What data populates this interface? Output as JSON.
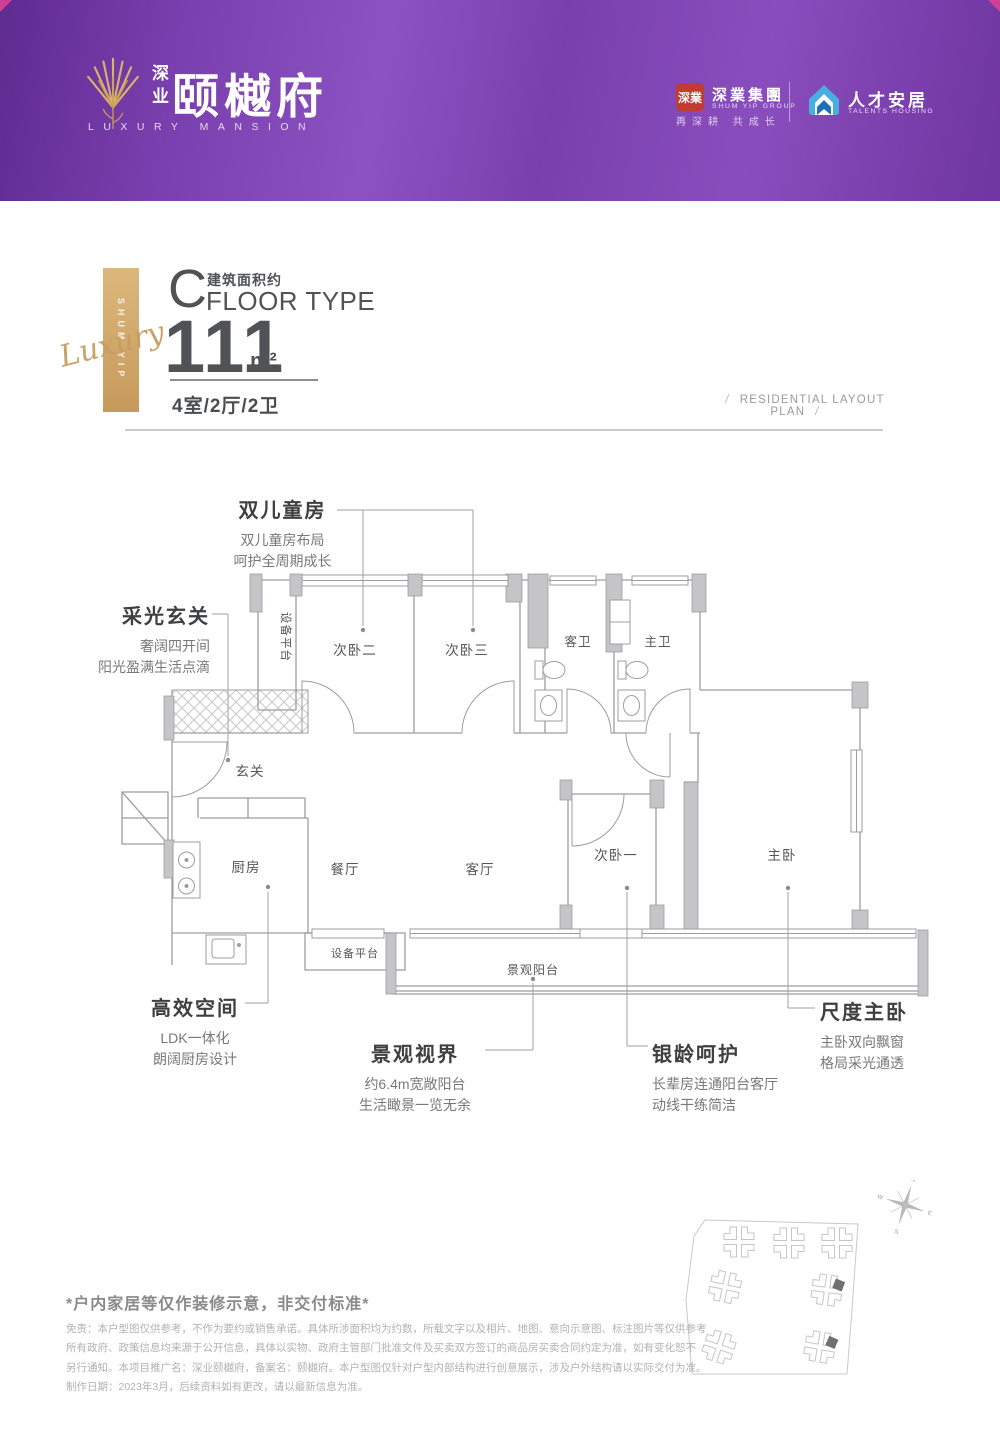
{
  "header": {
    "brand_cn_small": "深业",
    "brand_name": "颐樾府",
    "brand_en": "LUXURY MANSION",
    "partner_seal": "深業",
    "partner_name_cn": "深業集團",
    "partner_name_en": "SHUM YIP GROUP",
    "partner_slogan": "再深耕 共成长",
    "talents_name_cn": "人才安居",
    "talents_name_en": "TALENTS HOUSING"
  },
  "spec": {
    "type_letter": "C",
    "area_note": "建筑面积约",
    "type_label": "FLOOR TYPE",
    "area_value": "111",
    "area_unit": "m²",
    "rooms_summary": "4室/2厅/2卫",
    "plan_caption": "RESIDENTIAL LAYOUT PLAN",
    "ribbon_vertical": "SHUM YIP",
    "ribbon_script": "Luxury"
  },
  "plan_rooms": {
    "equipment_top": "设备平台",
    "bed2": "次卧二",
    "bed3": "次卧三",
    "guest_bath": "客卫",
    "master_bath": "主卫",
    "foyer": "玄关",
    "kitchen": "厨房",
    "dining": "餐厅",
    "living": "客厅",
    "bed1": "次卧一",
    "master_bed": "主卧",
    "equipment_bottom": "设备平台",
    "balcony": "景观阳台"
  },
  "callouts": {
    "children": {
      "t": "双儿童房",
      "l1": "双儿童房布局",
      "l2": "呵护全周期成长"
    },
    "foyer": {
      "t": "采光玄关",
      "l1": "奢阔四开间",
      "l2": "阳光盈满生活点滴"
    },
    "kitchen": {
      "t": "高效空间",
      "l1": "LDK一体化",
      "l2": "朗阔厨房设计"
    },
    "balcony": {
      "t": "景观视界",
      "l1": "约6.4m宽敞阳台",
      "l2": "生活瞰景一览无余"
    },
    "elder": {
      "t": "银龄呵护",
      "l1": "长辈房连通阳台客厅",
      "l2": "动线干练简洁"
    },
    "master": {
      "t": "尺度主卧",
      "l1": "主卧双向飘窗",
      "l2": "格局采光通透"
    }
  },
  "compass": {
    "n": "N",
    "e": "E",
    "s": "S",
    "w": "W"
  },
  "footer": {
    "notice": "*户内家居等仅作装修示意，非交付标准*",
    "line1": "免责：本户型图仅供参考，不作为要约或销售承诺。具体所涉面积均为约数，所载文字以及相片、地图、意向示意图、标注图片等仅供参考",
    "line2": "所有政府、政策信息均来源于公开信息，具体以实物、政府主管部门批准文件及买卖双方签订的商品房买卖合同约定为准，如有变化恕不",
    "line3": "另行通知。本项目推广名：深业颐樾府，备案名：颐樾府。本户型图仅针对户型内部结构进行创意展示，涉及户外结构请以实际交付为准。",
    "line4": "制作日期：2023年3月，后续资料如有更改，请以最新信息为准。"
  },
  "colors": {
    "brand_purple": "#7a3fae",
    "accent_pink": "#cf3f95",
    "gold": "#c69a5c",
    "seal_red": "#c23b31",
    "talents_blue": "#47aede",
    "ink_gray": "#515255",
    "plan_line": "#9d9da0"
  }
}
